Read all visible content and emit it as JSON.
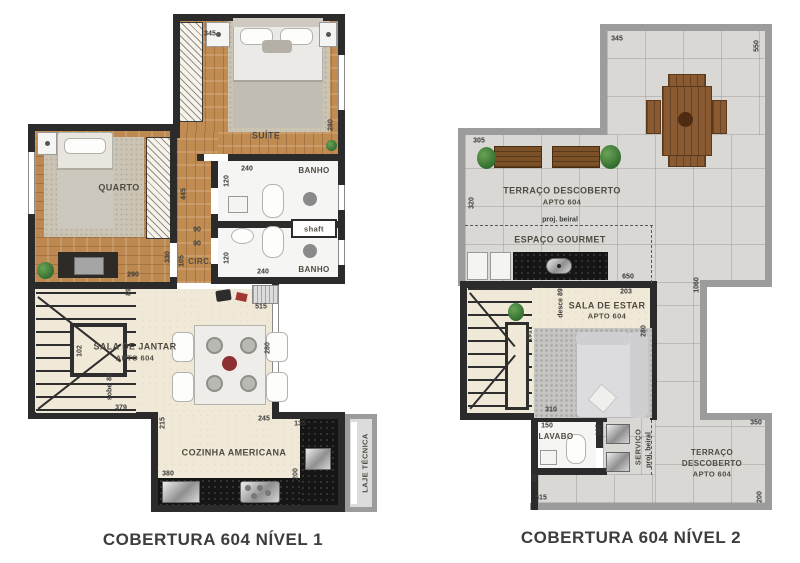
{
  "colors": {
    "interior_wall": "#2b2b2b",
    "terrace_wall": "#9c9c9c",
    "wood_floor": "#c08c52",
    "terrace_tile": "#d9d8d4",
    "living_floor": "#f1e9d8",
    "counter_granite": "#151515",
    "bench_wood": "#7d5128",
    "plant_green": "#2f6b2d"
  },
  "plan1": {
    "title": "COBERTURA 604 NÍVEL 1",
    "rooms": {
      "suite": "SUÍTE",
      "quarto": "QUARTO",
      "banho_top": "BANHO",
      "banho_bottom": "BANHO",
      "shaft": "shaft",
      "circ": "CIRC.",
      "sala_jantar_line1": "SALA DE JANTAR",
      "sala_jantar_line2": "APTO 604",
      "cozinha": "COZINHA AMERICANA",
      "laje_tecnica": "LAJE TÉCNICA",
      "sobe": "sobe"
    },
    "dims": {
      "suite_width": "345",
      "suite_height": "280",
      "banho_top_width": "240",
      "banho_top_height": "120",
      "banho_bottom_width": "240",
      "banho_bottom_height": "120",
      "quarto_width": "290",
      "quarto_height": "330",
      "corridor_length": "445",
      "circ_width_a": "90",
      "circ_width_b": "90",
      "circ_height": "105",
      "stairs_top": "89",
      "stairs_sobe": "89",
      "stairs_width": "102",
      "stairs_bottom": "379",
      "sala_top": "515",
      "sala_right": "280",
      "sala_bottom": "245",
      "cozinha_left": "215",
      "cozinha_top": "135",
      "cozinha_right": "200",
      "cozinha_counter": "380"
    }
  },
  "plan2": {
    "title": "COBERTURA 604 NÍVEL 2",
    "rooms": {
      "terraco_top_line1": "TERRAÇO DESCOBERTO",
      "terraco_top_line2": "APTO 604",
      "espaco_gourmet": "ESPAÇO GOURMET",
      "sala_estar_line1": "SALA DE ESTAR",
      "sala_estar_line2": "APTO 604",
      "lavabo": "LAVABO",
      "servico": "SERVIÇO",
      "terraco_bottom_line1": "TERRAÇO",
      "terraco_bottom_line2": "DESCOBERTO",
      "terraco_bottom_line3": "APTO 604",
      "proj_beiral_h": "proj. beiral",
      "proj_beiral_v": "proj. beiral",
      "desce": "desce 89"
    },
    "dims": {
      "terrace_top": "345",
      "terrace_top_right": "550",
      "terrace_left_top": "305",
      "terrace_left": "320",
      "gourmet_width": "650",
      "estar_top": "203",
      "estar_right": "280",
      "estar_bottom": "310",
      "stairs_height": "191",
      "lavabo_width": "150",
      "lavabo_height": "105",
      "below_lavabo": "80",
      "bottom_width": "515",
      "terrace_right_height": "1060",
      "terrace_bottom_top": "350",
      "terrace_bottom_right": "200"
    }
  }
}
